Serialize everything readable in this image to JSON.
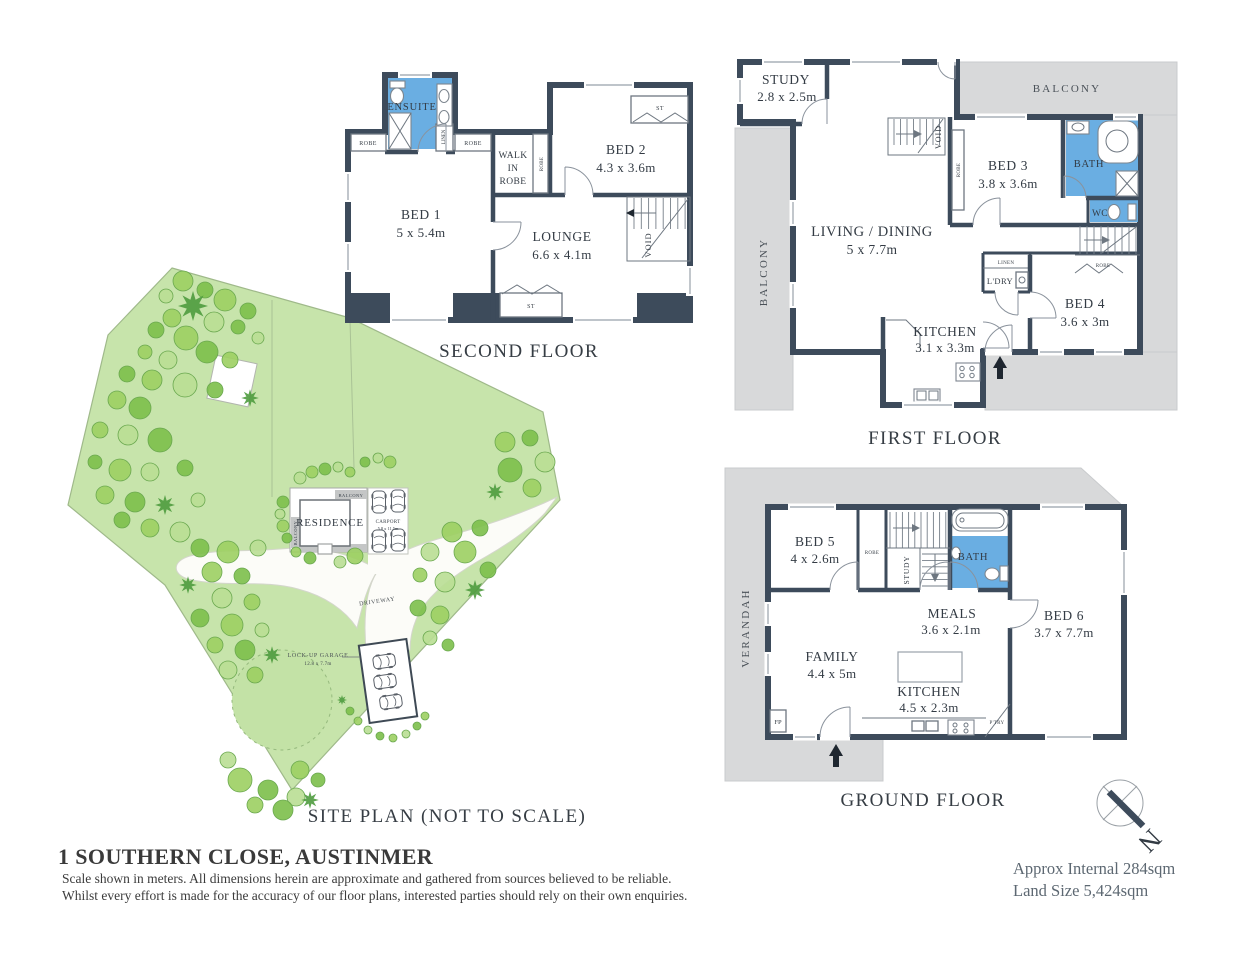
{
  "colors": {
    "wall": "#3d4b5b",
    "bathroom_blue": "#6aaee2",
    "balcony_gray": "#d8d9da",
    "site_green": "#c7e4ab",
    "tree_green": "#7cbf4a",
    "driveway_white": "#fcfcf8",
    "text_dark": "#333b44",
    "area_text": "#5d6872"
  },
  "second_floor": {
    "title": "SECOND FLOOR",
    "bed1_name": "BED 1",
    "bed1_dims": "5 x 5.4m",
    "bed2_name": "BED 2",
    "bed2_dims": "4.3 x 3.6m",
    "lounge_name": "LOUNGE",
    "lounge_dims": "6.6 x 4.1m",
    "ensuite": "ENSUITE",
    "wir_line1": "WALK",
    "wir_line2": "IN",
    "wir_line3": "ROBE",
    "robe_left": "ROBE",
    "robe_right": "ROBE",
    "robe_side": "ROBE",
    "linen": "LINEN",
    "st_top": "ST",
    "st_bottom": "ST",
    "void": "VOID"
  },
  "first_floor": {
    "title": "FIRST FLOOR",
    "study_name": "STUDY",
    "study_dims": "2.8 x 2.5m",
    "living_name": "LIVING / DINING",
    "living_dims": "5 x 7.7m",
    "bed3_name": "BED 3",
    "bed3_dims": "3.8 x 3.6m",
    "bed4_name": "BED 4",
    "bed4_dims": "3.6 x 3m",
    "kitchen_name": "KITCHEN",
    "kitchen_dims": "3.1 x 3.3m",
    "bath": "BATH",
    "wc": "WC",
    "ldry": "L'DRY",
    "linen": "LINEN",
    "robe_bed3": "ROBE",
    "robe_bed4": "ROBE",
    "void": "VOID",
    "balcony_top": "BALCONY",
    "balcony_left": "BALCONY"
  },
  "ground_floor": {
    "title": "GROUND FLOOR",
    "bed5_name": "BED 5",
    "bed5_dims": "4 x 2.6m",
    "bed6_name": "BED 6",
    "bed6_dims": "3.7 x 7.7m",
    "meals_name": "MEALS",
    "meals_dims": "3.6 x 2.1m",
    "family_name": "FAMILY",
    "family_dims": "4.4 x 5m",
    "kitchen_name": "KITCHEN",
    "kitchen_dims": "4.5 x 2.3m",
    "bath": "BATH",
    "verandah": "VERANDAH",
    "robe": "ROBE",
    "study": "STUDY",
    "fp": "FP",
    "ptry": "P'TRY"
  },
  "site_plan": {
    "title": "SITE PLAN (NOT TO SCALE)",
    "residence": "RESIDENCE",
    "balcony_top": "BALCONY",
    "balcony_left": "BALCONY",
    "carport_name": "CARPORT",
    "carport_dims": "5.8 x 11.5m",
    "garage_name": "LOCK-UP GARAGE",
    "garage_dims": "12.8 x 7.7m",
    "driveway": "DRIVEWAY"
  },
  "compass": {
    "letter": "N"
  },
  "footer": {
    "address": "1 SOUTHERN CLOSE, AUSTINMER",
    "disclaimer_line1": "Scale shown in meters. All dimensions herein are approximate and gathered from sources believed to be  reliable.",
    "disclaimer_line2": "Whilst every effort is made for the accuracy of our floor plans, interested parties should rely on their own enquiries.",
    "approx_internal": "Approx Internal 284sqm",
    "land_size": "Land Size 5,424sqm"
  }
}
